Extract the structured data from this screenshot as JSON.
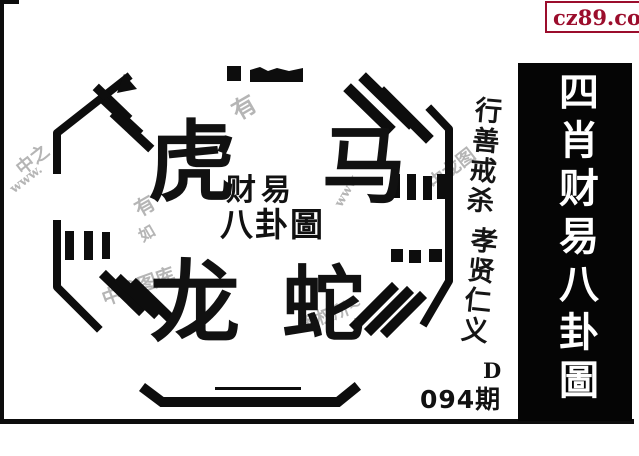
{
  "site_badge": {
    "text": "cz89.com",
    "text_color": "#9b0d2c",
    "border_color": "#9b0d2c",
    "icon_color": "#f7e400"
  },
  "banner": {
    "text": "四肖财易八卦圖",
    "bg_color": "#050505",
    "text_color": "#ffffff"
  },
  "diagram": {
    "animal_top_left": "虎",
    "animal_top_right": "马",
    "animal_bottom_left": "龙",
    "animal_bottom_right": "蛇",
    "title_line1": "财易",
    "title_line2": "八卦圖"
  },
  "motto": {
    "line1": "行善戒杀",
    "line2": "孝贤仁义"
  },
  "issue": {
    "letter": "D",
    "number": "094期"
  },
  "watermarks": [
    {
      "text": "中之"
    },
    {
      "text": "www."
    },
    {
      "text": "有"
    },
    {
      "text": "有"
    },
    {
      "text": "如"
    },
    {
      "text": "www"
    },
    {
      "text": "中龙图"
    },
    {
      "text": "中龙图库"
    },
    {
      "text": "板权所~"
    }
  ]
}
